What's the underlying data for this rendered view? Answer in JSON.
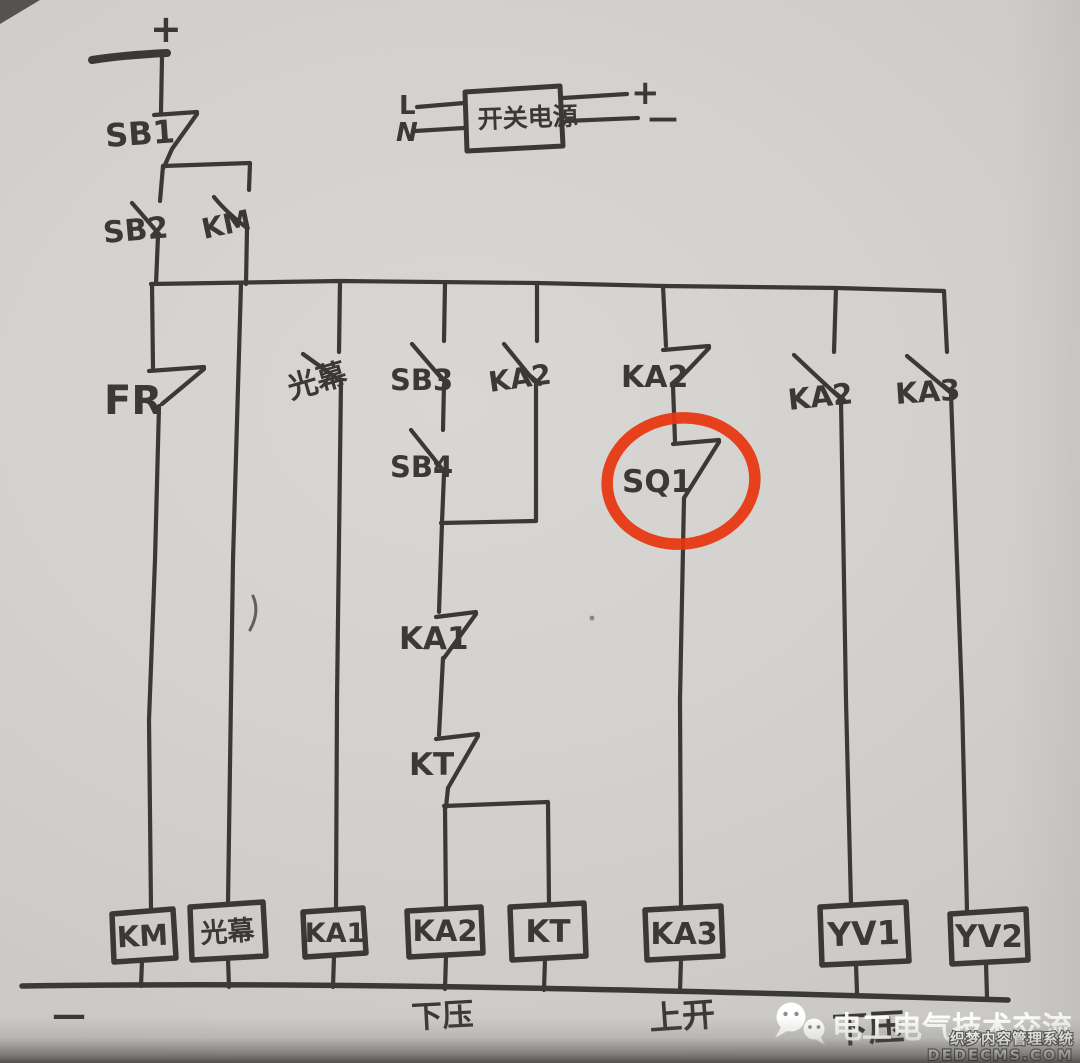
{
  "meta": {
    "description_title": "hand-drawn relay ladder circuit photo"
  },
  "colors": {
    "paper": "#d3d1cd",
    "ink": "#3b3935",
    "highlight_red": "#e8350e",
    "watermark_white": "#ffffff"
  },
  "rails": {
    "top_plus": "+",
    "bottom_minus": "—"
  },
  "power_supply": {
    "label": "开关电源",
    "terminal_l": "L",
    "terminal_n": "N",
    "terminal_plus": "+",
    "terminal_minus": "—"
  },
  "contacts": {
    "sb1": "SB1",
    "sb2": "SB2",
    "km": "KM",
    "fr": "FR",
    "light_curtain": "光幕",
    "sb3": "SB3",
    "sb4": "SB4",
    "ka2_parallel": "KA2",
    "ka2_nc": "KA2",
    "sq1": "SQ1",
    "ka1": "KA1",
    "kt": "KT",
    "ka2_right": "KA2",
    "ka3_right": "KA3"
  },
  "coils": {
    "km": "KM",
    "light_curtain": "光幕",
    "ka1": "KA1",
    "ka2": "KA2",
    "kt": "KT",
    "ka3": "KA3",
    "yv1": "YV1",
    "yv2": "YV2"
  },
  "bottom_labels": {
    "minus": "—",
    "down_press": "下压",
    "up_open": "上开",
    "down_press_2": "下压"
  },
  "watermark": {
    "brand": "电工电气技术交流",
    "cms_name": "织梦内容管理系统",
    "cms_domain": "DEDECMS.COM"
  }
}
